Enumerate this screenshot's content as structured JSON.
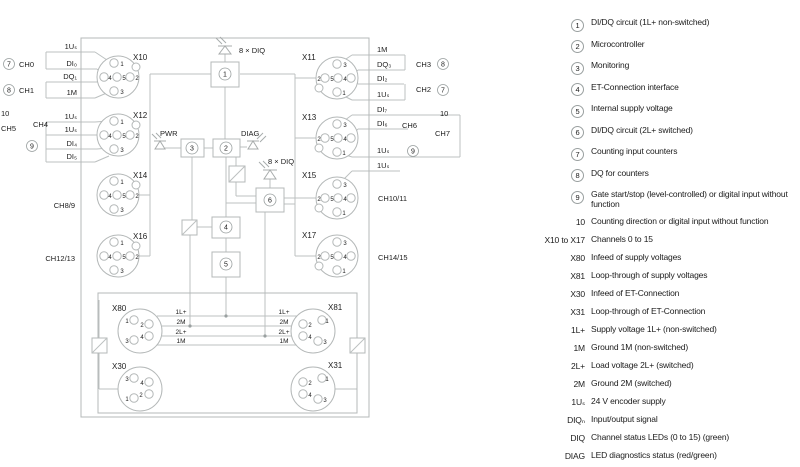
{
  "diagram": {
    "connectors": {
      "x10": "X10",
      "x11": "X11",
      "x12": "X12",
      "x13": "X13",
      "x14": "X14",
      "x15": "X15",
      "x16": "X16",
      "x17": "X17",
      "x80": "X80",
      "x81": "X81",
      "x30": "X30",
      "x31": "X31"
    },
    "pins": {
      "p1": "1",
      "p2": "2",
      "p3": "3",
      "p4": "4",
      "p5": "5"
    },
    "blocks": {
      "b1": "1",
      "b2": "2",
      "b3": "3",
      "b4": "4",
      "b5": "5",
      "b6": "6"
    },
    "labels": {
      "diq8": "8 × DIQ",
      "pwr": "PWR",
      "diag": "DIAG"
    },
    "left": {
      "rows": [
        "1Uₛ",
        "DI₀",
        "DQ₁",
        "1M",
        "1Uₛ",
        "1Uₛ",
        "DI₄",
        "DI₅"
      ],
      "n7": "7",
      "n8": "8",
      "n9": "9",
      "n10": "10",
      "ch0": "CH0",
      "ch1": "CH1",
      "ch4": "CH4",
      "ch5": "CH5",
      "ch89": "CH8/9",
      "ch1213": "CH12/13"
    },
    "right": {
      "rows": [
        "1M",
        "DQ₃",
        "DI₂",
        "1Uₛ",
        "DI₇",
        "DI₆",
        "1Uₛ",
        "1Uₛ"
      ],
      "n7": "7",
      "n8": "8",
      "n9": "9",
      "n10": "10",
      "ch2": "CH2",
      "ch3": "CH3",
      "ch6": "CH6",
      "ch7": "CH7",
      "ch1011": "CH10/11",
      "ch1415": "CH14/15"
    },
    "power": {
      "rows": [
        "1L+",
        "2M",
        "2L+",
        "1M"
      ]
    }
  },
  "legend": {
    "items": [
      {
        "key": "1",
        "text": "DI/DQ circuit (1L+ non-switched)"
      },
      {
        "key": "2",
        "text": "Microcontroller"
      },
      {
        "key": "3",
        "text": "Monitoring"
      },
      {
        "key": "4",
        "text": "ET-Connection interface"
      },
      {
        "key": "5",
        "text": "Internal supply voltage"
      },
      {
        "key": "6",
        "text": "DI/DQ circuit (2L+ switched)"
      },
      {
        "key": "7",
        "text": "Counting input counters"
      },
      {
        "key": "8",
        "text": "DQ for counters"
      },
      {
        "key": "9",
        "text": "Gate start/stop (level-controlled) or digital input without function"
      },
      {
        "key": "10",
        "text": "Counting direction or digital input without function"
      },
      {
        "key": "X10 to X17",
        "text": "Channels 0 to 15"
      },
      {
        "key": "X80",
        "text": "Infeed of supply voltages"
      },
      {
        "key": "X81",
        "text": "Loop-through of supply voltages"
      },
      {
        "key": "X30",
        "text": "Infeed of ET-Connection"
      },
      {
        "key": "X31",
        "text": "Loop-through of ET-Connection"
      },
      {
        "key": "1L+",
        "text": "Supply voltage 1L+ (non-switched)"
      },
      {
        "key": "1M",
        "text": "Ground 1M (non-switched)"
      },
      {
        "key": "2L+",
        "text": "Load voltage 2L+ (switched)"
      },
      {
        "key": "2M",
        "text": "Ground 2M (switched)"
      },
      {
        "key": "1Uₛ",
        "text": "24 V encoder supply"
      },
      {
        "key": "DIQₙ",
        "text": "Input/output signal"
      },
      {
        "key": "DIQ",
        "text": "Channel status LEDs (0 to 15) (green)"
      },
      {
        "key": "DIAG",
        "text": "LED diagnostics status (red/green)"
      },
      {
        "key": "PWR",
        "text": "LED supply voltage 2L+ (green)"
      }
    ]
  }
}
